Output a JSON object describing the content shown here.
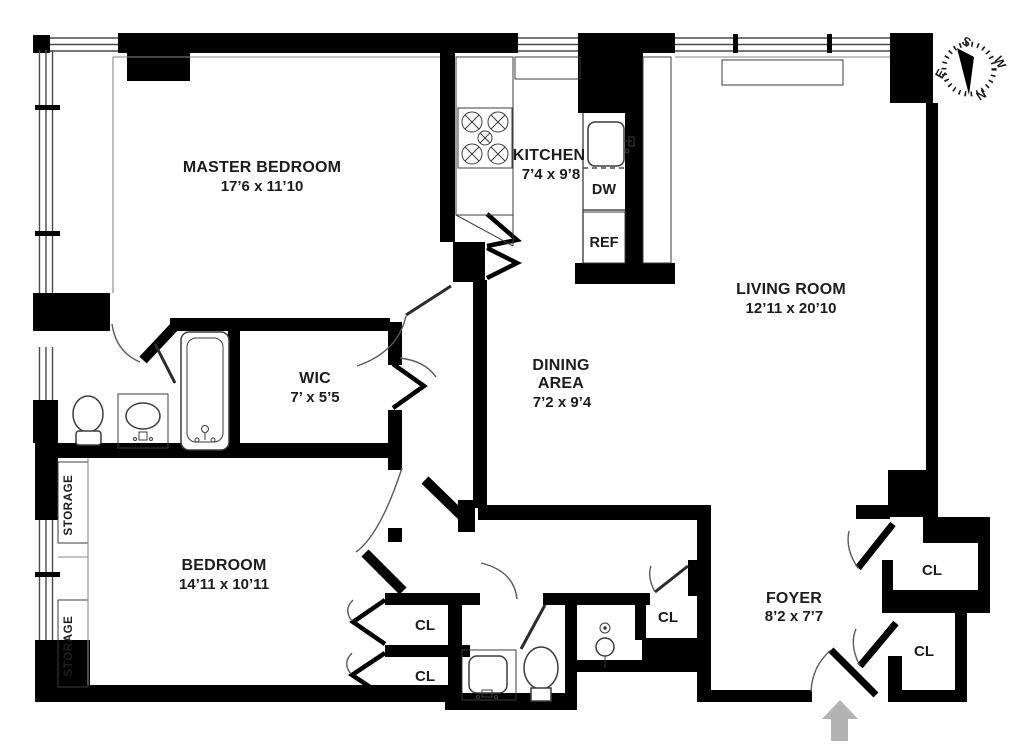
{
  "title": "Apartment floor plan",
  "colors": {
    "wall": "#000000",
    "background": "#ffffff",
    "detail_line": "#4a4a4a",
    "entry_arrow": "#b3b3b3",
    "text": "#1c1c1c"
  },
  "labels": {
    "master_bedroom": {
      "name": "MASTER BEDROOM",
      "dims": "17’6 x 11’10"
    },
    "kitchen": {
      "name": "KITCHEN",
      "dims": "7’4 x 9’8"
    },
    "living_room": {
      "name": "LIVING ROOM",
      "dims": "12’11 x 20’10"
    },
    "dining_area": {
      "name_line1": "DINING",
      "name_line2": "AREA",
      "dims": "7’2 x 9’4"
    },
    "wic": {
      "name": "WIC",
      "dims": "7’ x 5’5"
    },
    "bedroom": {
      "name": "BEDROOM",
      "dims": "14’11 x 10’11"
    },
    "foyer": {
      "name": "FOYER",
      "dims": "8’2 x 7’7"
    },
    "closet": "CL",
    "storage": "STORAGE",
    "dishwasher": "DW",
    "refrigerator": "REF"
  },
  "compass": {
    "north": "N",
    "south": "S",
    "east": "E",
    "west": "W"
  }
}
